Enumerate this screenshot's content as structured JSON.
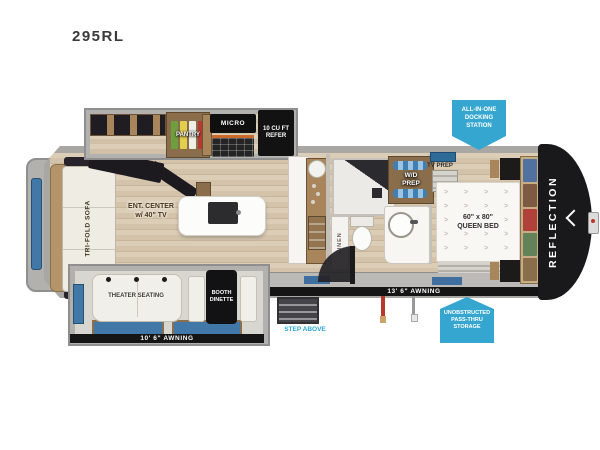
{
  "title": "295RL",
  "brand": "REFLECTION",
  "colors": {
    "accent_blue": "#2BA6D6",
    "badge_blue": "#35A6CF",
    "awning_black": "#151515",
    "window_blue": "#4178A8",
    "cabinet_brown": "#8A6E4B",
    "floor_tan": "#D8C9B2"
  },
  "living": {
    "sofa": "TRI-FOLD SOFA",
    "ent_line1": "ENT. CENTER",
    "ent_line2": "w/ 40\" TV",
    "theater": "THEATER SEATING",
    "dinette_line1": "BOOTH",
    "dinette_line2": "DINETTE"
  },
  "kitchen": {
    "pantry": "PANTRY",
    "micro": "MICRO",
    "refer_line1": "10 CU FT",
    "refer_line2": "REFER"
  },
  "bath": {
    "linen": "LINEN",
    "wd_line1": "W/D",
    "wd_line2": "PREP"
  },
  "bedroom": {
    "tv_prep": "TV PREP",
    "bed_line1": "60\" x 80\"",
    "bed_line2": "QUEEN BED"
  },
  "awnings": {
    "left": "10' 6\" AWNING",
    "right": "13' 6\" AWNING"
  },
  "badges": {
    "docking_line1": "ALL-IN-ONE",
    "docking_line2": "DOCKING",
    "docking_line3": "STATION",
    "storage_line1": "UNOBSTRUCTED",
    "storage_line2": "PASS-THRU",
    "storage_line3": "STORAGE",
    "step_above": "STEP ABOVE"
  }
}
